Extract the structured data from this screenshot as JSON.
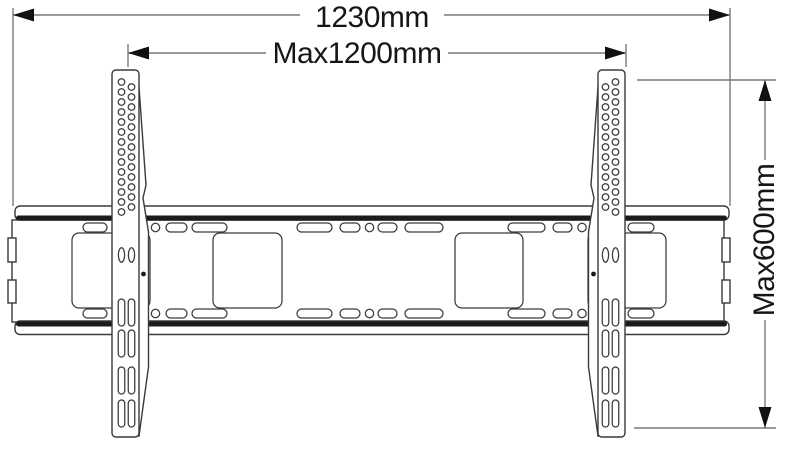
{
  "diagram": {
    "kind": "technical dimension drawing",
    "subject": "TV wall-mount bracket (wall plate with two vertical arms)",
    "dimensions": {
      "total_width_label": "1230mm",
      "max_width_label": "Max1200mm",
      "max_height_label": "Max600mm"
    }
  },
  "colors": {
    "background": "#ffffff",
    "outline": "#3a3a3a",
    "band": "#1b1b1b",
    "dimension_line": "#7a7a7a",
    "arrow": "#111111",
    "text": "#161616"
  }
}
